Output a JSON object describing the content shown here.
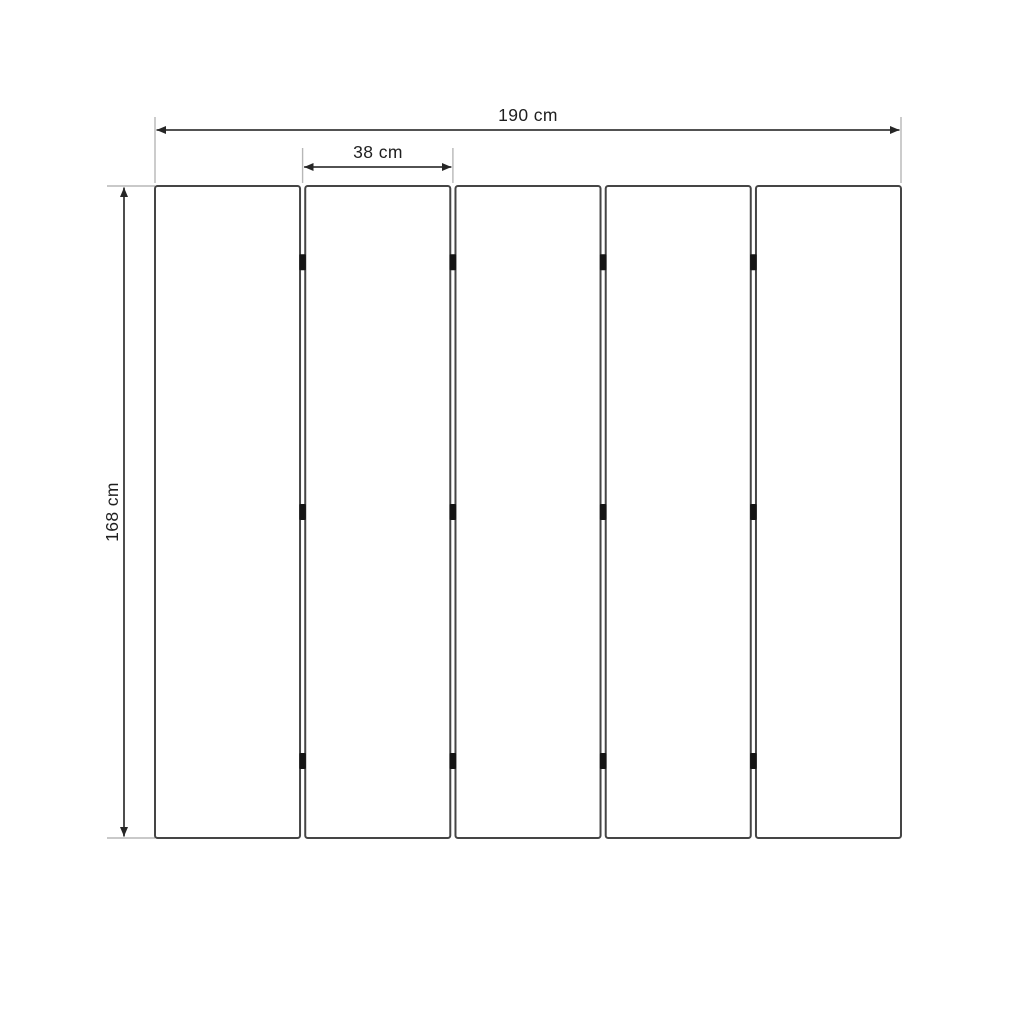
{
  "drawing": {
    "type": "dimensioned-panel-drawing",
    "dimensions": {
      "total_width": {
        "label": "190 cm",
        "value": 190,
        "unit": "cm"
      },
      "panel_width": {
        "label": "38 cm",
        "value": 38,
        "unit": "cm"
      },
      "height": {
        "label": "168 cm",
        "value": 168,
        "unit": "cm"
      }
    },
    "panels": {
      "count": 5,
      "hinges_per_gap": 3,
      "hinge_fractions": [
        0.117,
        0.5,
        0.882
      ]
    },
    "colors": {
      "background": "#ffffff",
      "dimension_line": "#3a3a3a",
      "extension_line": "#b7b7b7",
      "panel_border": "#454545",
      "panel_fill": "#ffffff",
      "hinge": "#141414",
      "text": "#1f1f1f"
    }
  }
}
